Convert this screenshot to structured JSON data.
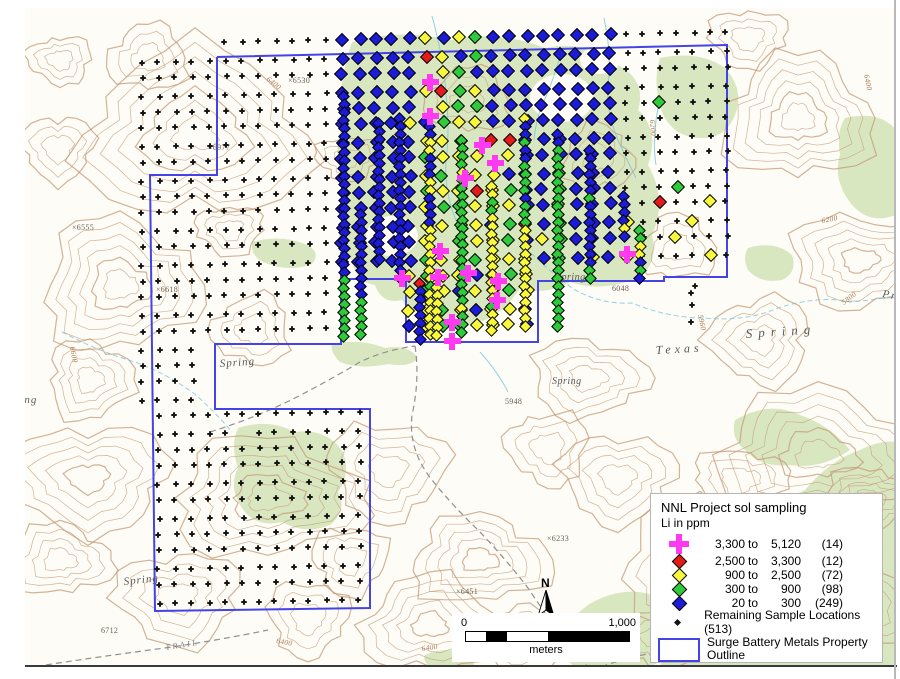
{
  "map": {
    "colors": {
      "k": "#151515",
      "b": "#1c1cd6",
      "g": "#2fc93c",
      "y": "#f7f73e",
      "r": "#e31b1b",
      "M": "#ff38f2",
      "outline": "#4343e6",
      "vegetation": "#d9e7c1",
      "contour": "#c49a76",
      "stream": "#6fc3dd"
    },
    "legend": {
      "title": "NNL Project sol sampling",
      "subtitle": "Li in ppm",
      "to_word": "to",
      "classes": [
        {
          "symbol": "cross",
          "color": "#ff38f2",
          "lo": "3,300",
          "hi": "5,120",
          "count": "(14)"
        },
        {
          "symbol": "diamond",
          "color": "#e31b1b",
          "lo": "2,500",
          "hi": "3,300",
          "count": "(12)"
        },
        {
          "symbol": "diamond",
          "color": "#f7f73e",
          "lo": "900",
          "hi": "2,500",
          "count": "(72)"
        },
        {
          "symbol": "diamond",
          "color": "#2fc93c",
          "lo": "300",
          "hi": "900",
          "count": "(98)"
        },
        {
          "symbol": "diamond",
          "color": "#1c1cd6",
          "lo": "20",
          "hi": "300",
          "count": "(249)"
        }
      ],
      "remaining_label": "Remaining Sample Locations (513)",
      "outline_label_line1": "Surge Battery Metals Property",
      "outline_label_line2": "Outline"
    },
    "scale_bar": {
      "start": "0",
      "end": "1,000",
      "units": "meters"
    },
    "north": {
      "label": "N"
    },
    "labels": {
      "springs": [
        {
          "t": "Spring",
          "x": 220,
          "y": 367,
          "s": 11,
          "ls": 1,
          "r": -4
        },
        {
          "t": "Spring",
          "x": 556,
          "y": 280,
          "s": 10,
          "ls": 0.5,
          "r": 0
        },
        {
          "t": "Spring",
          "x": 552,
          "y": 384,
          "s": 10,
          "ls": 0.5,
          "r": 0
        },
        {
          "t": "Texas",
          "x": 656,
          "y": 354,
          "s": 12,
          "ls": 4,
          "r": -3
        },
        {
          "t": "Spring",
          "x": 746,
          "y": 338,
          "s": 13,
          "ls": 6,
          "r": -4
        },
        {
          "t": "Spring",
          "x": 124,
          "y": 585,
          "s": 11,
          "ls": 1,
          "r": -6
        },
        {
          "t": "Spring",
          "x": 2,
          "y": 403,
          "s": 11,
          "ls": 1,
          "r": 0
        },
        {
          "t": "Pr",
          "x": 882,
          "y": 297,
          "s": 11,
          "ls": 2,
          "r": 10
        }
      ],
      "elevations": [
        {
          "t": "×6977",
          "x": 208,
          "y": 150
        },
        {
          "t": "×6555",
          "x": 72,
          "y": 230
        },
        {
          "t": "×6618",
          "x": 156,
          "y": 292
        },
        {
          "t": "×6530",
          "x": 288,
          "y": 83
        },
        {
          "t": "6048",
          "x": 612,
          "y": 291
        },
        {
          "t": "5948",
          "x": 505,
          "y": 404
        },
        {
          "t": "×6233",
          "x": 547,
          "y": 541
        },
        {
          "t": "×6451",
          "x": 456,
          "y": 594
        },
        {
          "t": "×6283",
          "x": 601,
          "y": 661
        },
        {
          "t": "6712",
          "x": 101,
          "y": 633
        }
      ],
      "contours": [
        {
          "t": "6400",
          "x": 276,
          "y": 643,
          "r": 10
        },
        {
          "t": "6400",
          "x": 422,
          "y": 651,
          "r": -8
        },
        {
          "t": "6400",
          "x": 864,
          "y": 75,
          "r": 78
        },
        {
          "t": "6200",
          "x": 822,
          "y": 223,
          "r": -10
        },
        {
          "t": "5800",
          "x": 844,
          "y": 305,
          "r": -38
        },
        {
          "t": "5960",
          "x": 698,
          "y": 315,
          "r": 78
        },
        {
          "t": "6400",
          "x": 266,
          "y": 80,
          "r": 38
        },
        {
          "t": "6600",
          "x": 70,
          "y": 347,
          "r": 80
        },
        {
          "t": "6400",
          "x": 858,
          "y": 642,
          "r": -30
        },
        {
          "t": "6200",
          "x": 650,
          "y": 120,
          "r": 85
        }
      ],
      "trail": {
        "t": "TRAIL",
        "x": 166,
        "y": 650,
        "r": -9
      }
    },
    "property_outline": {
      "points": [
        [
          217,
          57
        ],
        [
          727,
          45
        ],
        [
          727,
          277
        ],
        [
          664,
          277
        ],
        [
          664,
          281
        ],
        [
          538,
          281
        ],
        [
          538,
          342
        ],
        [
          406,
          342
        ],
        [
          406,
          279
        ],
        [
          341,
          279
        ],
        [
          341,
          344
        ],
        [
          215,
          344
        ],
        [
          215,
          409
        ],
        [
          370,
          409
        ],
        [
          370,
          608
        ],
        [
          155,
          611
        ],
        [
          150,
          175
        ],
        [
          217,
          175
        ]
      ],
      "stub": [
        [
          341,
          279
        ],
        [
          341,
          252
        ]
      ]
    },
    "markers": {
      "grid": {
        "x0": 142,
        "y0": 45,
        "dx": 16.7,
        "dy": 16.9,
        "rows": [
          ".....kkkkkkkbbbbbybygbbbbbbbbkkkkkkk",
          "kkkkkkkkkkkkbbbbbrybgbbbbbbbbkkkkkkk",
          "kkkkkkkkkkkkbbbbb.ygbbbbbbbbbkkkkkkk",
          "kkkkkkkkkkkkbbbbbyrgybbbbbbbbkkkkkkk",
          "kkkkkkkkkkkkbbbbb.yggbbbbbbbbkkgkkkk",
          "kkkkkkkkkkkkbbbbybgyybbbbbbbbkkkkkkk",
          "kkkkkkkkkkkkbbbbbyyg.rrbbbbbbkkkkkkk",
          "kkkkkkkkkkkkbbbbbgyyy.ybbbbbbkkkkkkk",
          "kkkkkkkkkkkkbbbbbyg.yybbbgbbbkkkkkkk",
          "kkkkkkkkkkkkbbbbbgyyrygbbgbbbkkkgkkk",
          "kkkkkkkkkkkkbbbbbyggyyybbgbbbkkrkkyk",
          "kkkkkkkkkkkkbbbbbyygybgrbgbbbykkkykk",
          "kkkkkkkkkkkkbbbbby.gyygbygbbb.kkykkk",
          "kkkkkkkkkkkkbbbbbgyygyyybgbybykkkkyk",
          "kkkkkkkkkkkk....ygyybygy............",
          "kkkkkkkkkkkk....ygybyygy.........k..",
          "kkkkkkkkkkkk....yygybyyb.........k..",
          "kkkkkkkkkkkk....byggyyyb............",
          "kkkk................................",
          "kkkk................................",
          "kkkk................................",
          "kkkk................................",
          ".kkkkkkkkkkkkk......................",
          ".kkkkk.kkkkkkk......................",
          ".kkkkkkkkkkkkk......................",
          ".kkkkkkkkkkkkk......................",
          ".kkkkkkkkkkkkk......................",
          ".kkkkkkkkkkkkk......................",
          ".kkkkkkkkkkkkk......................",
          ".kkkkkkkkkkkkk......................",
          ".kkkkkkkkkkkkk......................",
          ".kkkkkkkkkkkkk......................",
          ".kkkkkkkkkkkkk......................",
          ".kkkkkkkkkkkkk......................"
        ]
      },
      "chains": [
        {
          "x": 344,
          "y": 96,
          "c": "bbbbbbbbbbbbbbbbbbbbbbbgggggggg"
        },
        {
          "x": 361,
          "y": 214,
          "c": "bbbbbbbbbbbggggg"
        },
        {
          "x": 379,
          "y": 123,
          "c": "bbbbbbbbbbbbbbbbbb"
        },
        {
          "x": 400,
          "y": 118,
          "c": "bbbbbbbbbbbbbbbbbbbbb"
        },
        {
          "x": 430,
          "y": 126,
          "c": "bbyybbbyybbbbyyyyyyygyyyyyy"
        },
        {
          "x": 462,
          "y": 140,
          "c": "ggggyggggggggggggggggyggg"
        },
        {
          "x": 492,
          "y": 186,
          "c": "yyggyyyyyyyyyyygyyy"
        },
        {
          "x": 525,
          "y": 118,
          "c": "ybbgbbggggbgggyyyyyyyyyyyyy"
        },
        {
          "x": 558,
          "y": 134,
          "c": "bbggggggggggggggggggggggg"
        },
        {
          "x": 590,
          "y": 150,
          "c": "bbbbbbgbbbbbbbbgg"
        },
        {
          "x": 624,
          "y": 196,
          "c": "bbbbyb"
        },
        {
          "x": 640,
          "y": 230,
          "c": "ggyybgb"
        },
        {
          "x": 437,
          "y": 287,
          "c": "yyyyyyy"
        },
        {
          "x": 420,
          "y": 283,
          "c": "rbbbbbbb"
        }
      ],
      "crosses": [
        [
          430,
          82
        ],
        [
          430,
          116
        ],
        [
          482,
          145
        ],
        [
          495,
          163
        ],
        [
          465,
          178
        ],
        [
          440,
          251
        ],
        [
          627,
          254
        ],
        [
          402,
          278
        ],
        [
          438,
          277
        ],
        [
          468,
          273
        ],
        [
          498,
          281
        ],
        [
          497,
          300
        ],
        [
          452,
          322
        ],
        [
          452,
          341
        ]
      ],
      "extra_black": [
        [
          691,
          293
        ],
        [
          691,
          322
        ]
      ]
    }
  }
}
